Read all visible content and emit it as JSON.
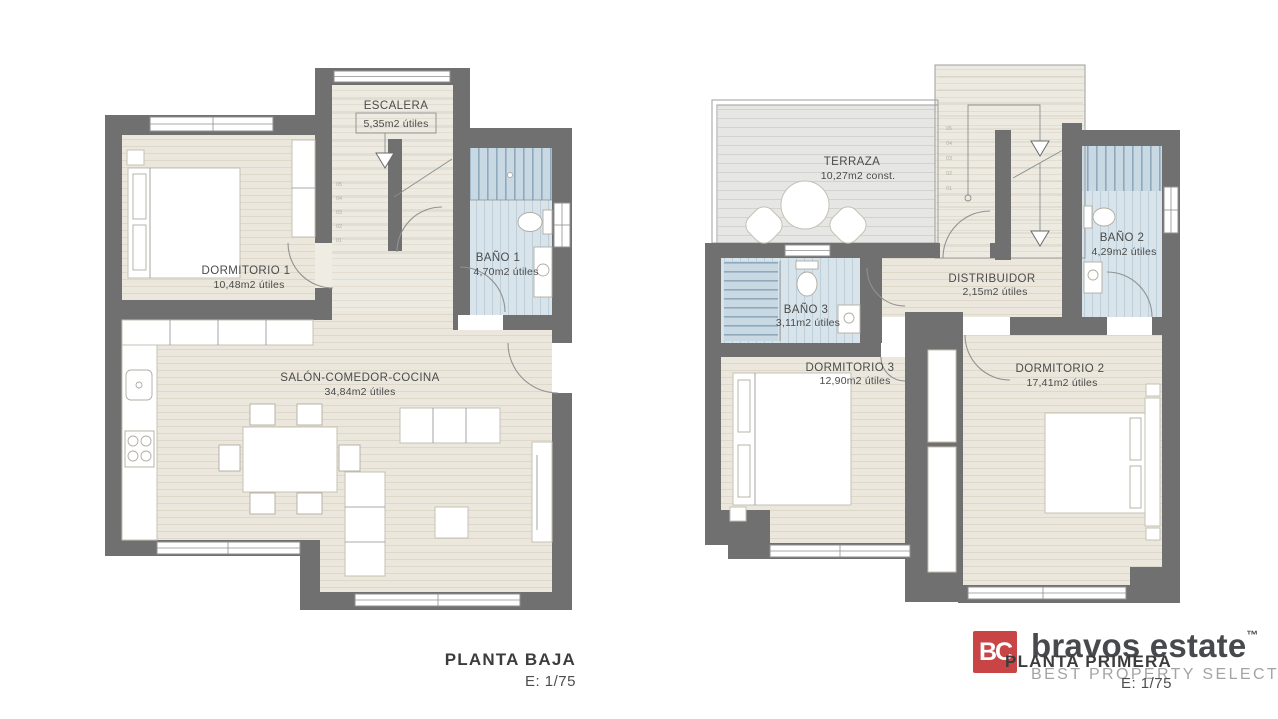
{
  "planta_baja": {
    "title": "PLANTA BAJA",
    "scale": "E: 1/75",
    "rooms": {
      "escalera": {
        "name": "ESCALERA",
        "area": "5,35m2 útiles"
      },
      "dormitorio1": {
        "name": "DORMITORIO 1",
        "area": "10,48m2 útiles"
      },
      "bano1": {
        "name": "BAÑO 1",
        "area": "4,70m2 útiles"
      },
      "salon": {
        "name": "SALÓN-COMEDOR-COCINA",
        "area": "34,84m2 útiles"
      }
    },
    "step_numbers": [
      "05",
      "04",
      "03",
      "02",
      "01"
    ]
  },
  "planta_primera": {
    "title": "PLANTA PRIMERA",
    "scale": "E: 1/75",
    "rooms": {
      "terraza": {
        "name": "TERRAZA",
        "area": "10,27m2 const."
      },
      "bano3": {
        "name": "BAÑO 3",
        "area": "3,11m2 útiles"
      },
      "distribuidor": {
        "name": "DISTRIBUIDOR",
        "area": "2,15m2 útiles"
      },
      "bano2": {
        "name": "BAÑO 2",
        "area": "4,29m2 útiles"
      },
      "dormitorio3": {
        "name": "DORMITORIO 3",
        "area": "12,90m2 útiles"
      },
      "dormitorio2": {
        "name": "DORMITORIO 2",
        "area": "17,41m2 útiles"
      }
    },
    "step_numbers": [
      "05",
      "04",
      "03",
      "02",
      "01"
    ]
  },
  "branding": {
    "monogram": "BC",
    "name": "bravos estate",
    "trademark": "™",
    "tagline": "BEST PROPERTY SELECTION"
  },
  "colors": {
    "wall": "#707070",
    "floor": "#ebe7dd",
    "bathroom": "#d8e3ea",
    "terrace": "#e6e6e4",
    "logo_red": "#c94545",
    "text": "#4b4b4b"
  }
}
